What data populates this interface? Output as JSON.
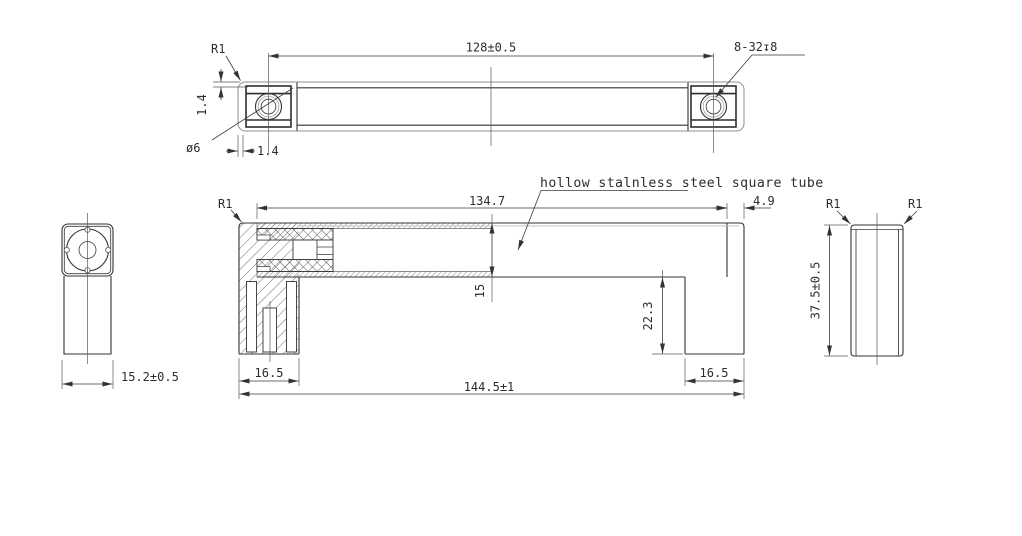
{
  "colors": {
    "line": "#333333",
    "background": "#ffffff"
  },
  "note": "hollow stalnless steel square tube",
  "top_view": {
    "fillet_radius": "R1",
    "dim_hole_spacing": "128±0.5",
    "thread_callout": "8-32↧8",
    "dim_wall_side": "1.4",
    "hole_diameter": "ø6",
    "dim_wall_bottom": "1.4"
  },
  "front_view": {
    "fillet_radius": "R1",
    "dim_tube_length": "134.7",
    "dim_end_face": "4.9",
    "dim_tube_height": "15",
    "dim_leg_drop": "22.3",
    "dim_leg_width_left": "16.5",
    "dim_leg_width_right": "16.5",
    "dim_overall_length": "144.5±1"
  },
  "left_view": {
    "dim_depth": "15.2±0.5"
  },
  "right_view": {
    "fillet_left": "R1",
    "fillet_right": "R1",
    "dim_height": "37.5±0.5"
  }
}
